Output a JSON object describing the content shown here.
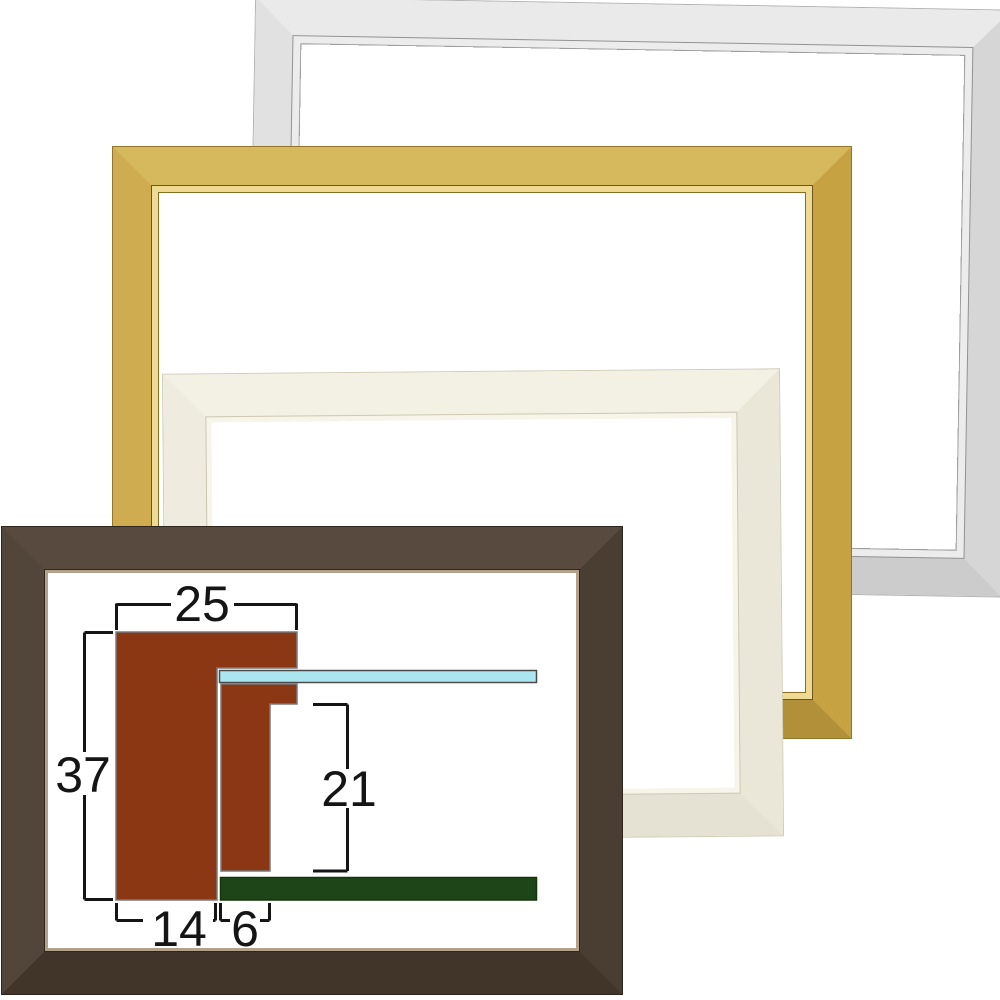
{
  "frames": [
    {
      "id": "silver",
      "face_color": "#dedede"
    },
    {
      "id": "gold",
      "face_color": "#c9a447"
    },
    {
      "id": "cream",
      "face_color": "#efecdf"
    },
    {
      "id": "dark-brown",
      "face_color": "#4c3f34"
    }
  ],
  "diagram": {
    "labels": {
      "top_width": "25",
      "overall_height": "37",
      "inner_depth": "21",
      "base_width": "14",
      "liner_width": "6"
    },
    "colors": {
      "molding": "#8c3714",
      "glass": "#abe6f0",
      "backboard": "#1d4517",
      "dimension": "#151515",
      "outline": "#7a7a7a",
      "glass_outline": "#4a4a4a",
      "backboard_outline": "#143608"
    }
  }
}
